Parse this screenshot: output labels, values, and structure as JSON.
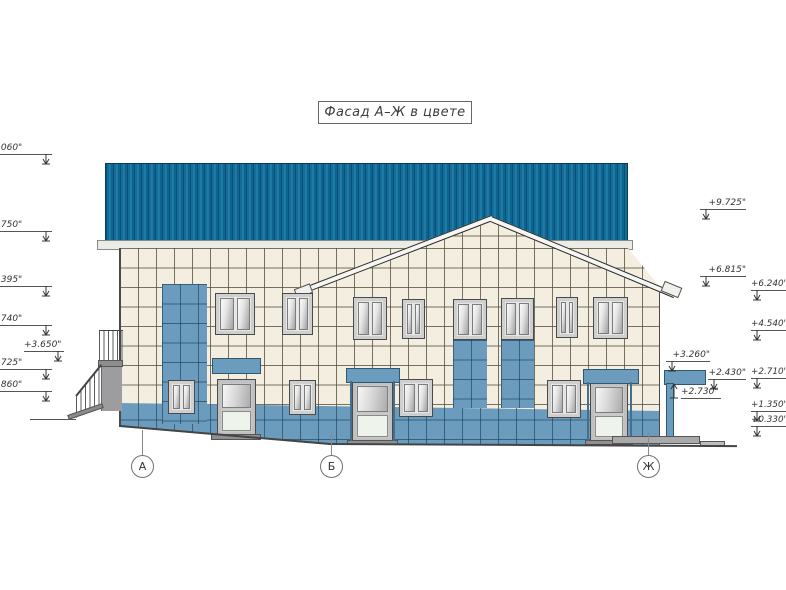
{
  "title": {
    "text": "Фасад А–Ж в цвете"
  },
  "axis_markers": [
    {
      "label": "А"
    },
    {
      "label": "Б"
    },
    {
      "label": "Ж"
    }
  ],
  "elevation_marks": {
    "left": [
      {
        "text": ".060\""
      },
      {
        "text": ".750\""
      },
      {
        "text": ".395\""
      },
      {
        "text": ".740\""
      },
      {
        "text": "+3.650\""
      },
      {
        "text": ".725\""
      },
      {
        "text": ".860\""
      }
    ],
    "mid_right": [
      {
        "text": "+9.725\""
      },
      {
        "text": "+6.815\""
      },
      {
        "text": "+3.260\""
      },
      {
        "text": "+2.430\""
      },
      {
        "text": "+2.730\""
      }
    ],
    "right_edge": [
      {
        "text": "+6.240\""
      },
      {
        "text": "+4.540\""
      },
      {
        "text": "+2.710\""
      },
      {
        "text": "+1.350\""
      },
      {
        "text": "+0.330\""
      }
    ]
  },
  "colors": {
    "roof_blue": "#1374a4",
    "accent_blue": "#6b9cbd",
    "wall_cream": "#f3eee0"
  }
}
